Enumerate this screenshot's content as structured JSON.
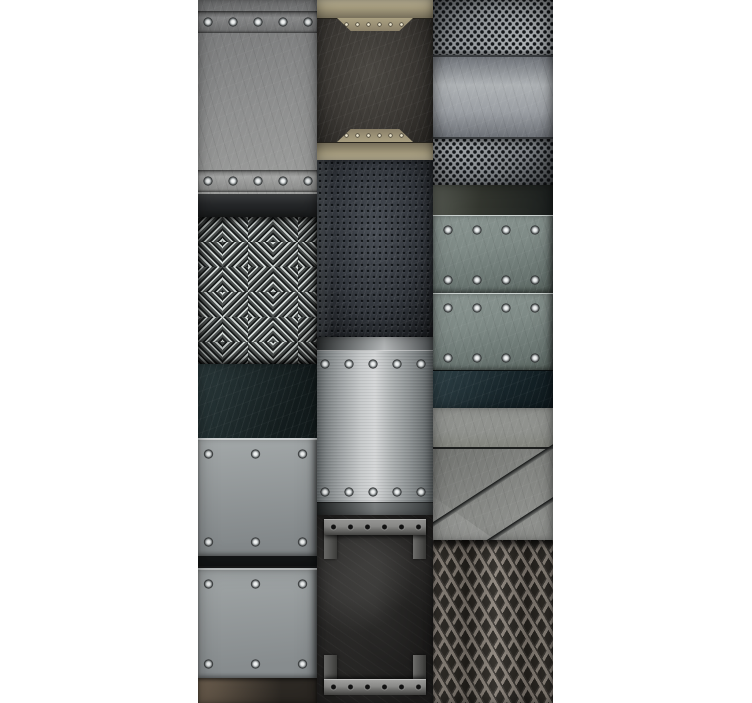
{
  "image": {
    "type": "texture-collage",
    "alt": "Collage of twelve industrial metal texture swatches arranged in three vertical columns on a white background",
    "background": "#ffffff",
    "grid": {
      "columns": 3,
      "x": 198,
      "y": 0,
      "width": 355,
      "height": 703
    },
    "tiles": [
      {
        "name": "Scratched steel plate with riveted bands",
        "column": 1,
        "row": 1,
        "rivet_rows": 2,
        "rivets_per_row": 5,
        "palette": [
          "#737475",
          "#8e8f8f",
          "#a2a3a1",
          "#26282a"
        ]
      },
      {
        "name": "Diamond tread plate",
        "column": 1,
        "row": 2,
        "palette": [
          "#4c504f",
          "#9aa19f",
          "#242726"
        ]
      },
      {
        "name": "Dark teal panel over riveted silver plate",
        "column": 1,
        "row": 3,
        "rivet_rows": 2,
        "rivets_per_row": 3,
        "palette": [
          "#2b3a3c",
          "#131c1d",
          "#a3a8a9",
          "#83888a"
        ]
      },
      {
        "name": "Riveted silver plate with worn bronze footer",
        "column": 1,
        "row": 4,
        "rivet_rows": 2,
        "rivets_per_row": 3,
        "palette": [
          "#a1a6a7",
          "#878c8e",
          "#6e6050",
          "#2d2924"
        ]
      },
      {
        "name": "Grunge plaque framed by tan metal bands and tabs",
        "column": 2,
        "row": 1,
        "tabs": 2,
        "tab_rivets": 6,
        "palette": [
          "#aca283",
          "#6b6352",
          "#3a3733",
          "#1e1c19"
        ]
      },
      {
        "name": "Perforated dark slate panel",
        "column": 2,
        "row": 2,
        "palette": [
          "#474c53",
          "#31353b",
          "#17191c"
        ]
      },
      {
        "name": "Brushed aluminum riveted plate",
        "column": 2,
        "row": 3,
        "rivet_rows": 2,
        "rivets_per_row": 5,
        "palette": [
          "#6f7577",
          "#c7cacb",
          "#d5d7d8",
          "#565c5e"
        ]
      },
      {
        "name": "Grunge door with bolted clamp bars",
        "column": 2,
        "row": 4,
        "clamp_bars": 2,
        "holes_per_bar": 6,
        "palette": [
          "#403f3d",
          "#232221",
          "#8d8d8b",
          "#585856"
        ]
      },
      {
        "name": "Perforated steel with solid horizontal band",
        "column": 3,
        "row": 1,
        "palette": [
          "#8a8e92",
          "#aeb2b5",
          "#6c7074",
          "#1b1e20"
        ]
      },
      {
        "name": "Blue steel riveted plates with dark bands",
        "column": 3,
        "row": 2,
        "plates": 2,
        "rivet_rows": 4,
        "rivets_per_row": 4,
        "palette": [
          "#7e8a86",
          "#66726e",
          "#2e4046",
          "#1b1f1e"
        ]
      },
      {
        "name": "Diagonal metal panels",
        "column": 3,
        "row": 3,
        "palette": [
          "#8f918d",
          "#7d7f7b",
          "#9b9d99",
          "#292b2a"
        ]
      },
      {
        "name": "Expanded metal mesh",
        "column": 3,
        "row": 4,
        "palette": [
          "#8a8279",
          "#3a3631",
          "#27241f"
        ]
      }
    ]
  }
}
